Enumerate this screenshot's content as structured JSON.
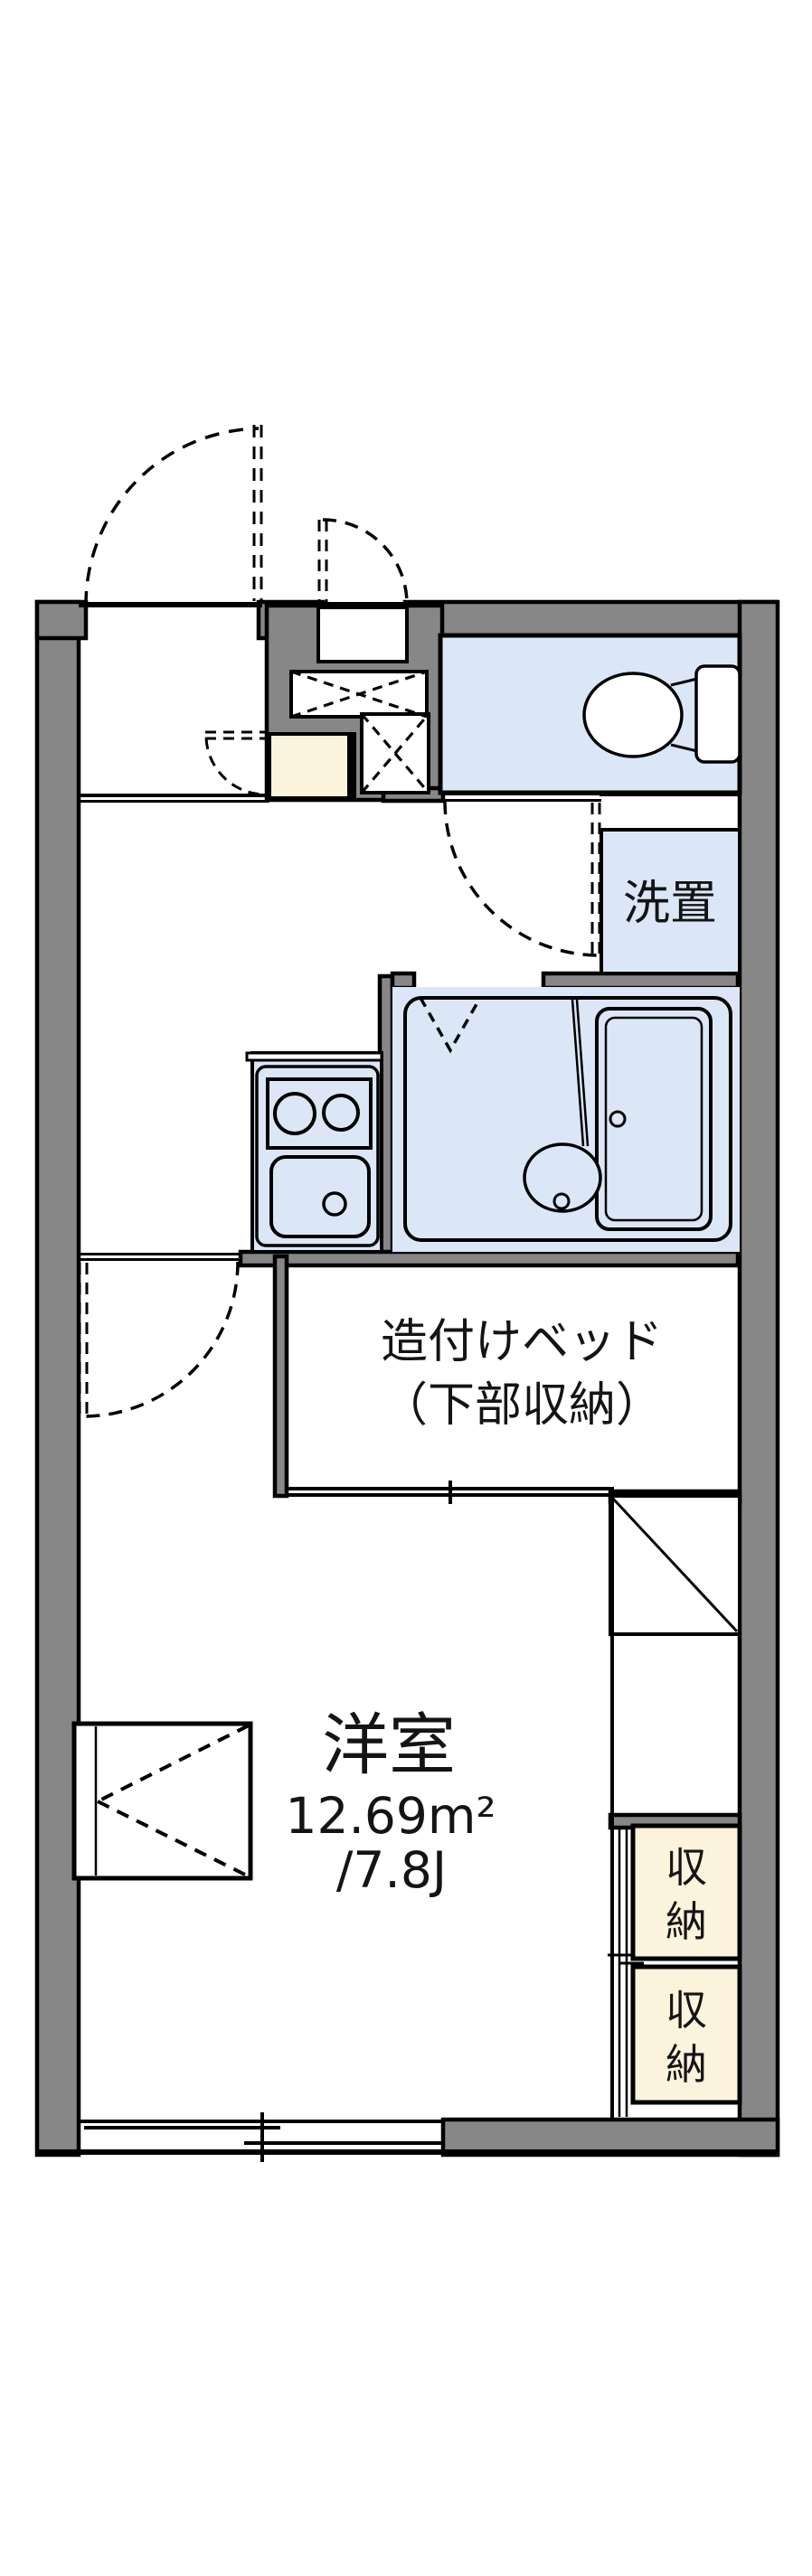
{
  "floorplan": {
    "labels": {
      "main_room_name": "洋室",
      "main_room_area_m2": "12.69m²",
      "main_room_area_tatami": "/7.8J",
      "built_in_bed_line1": "造付けベッド",
      "built_in_bed_line2": "（下部収納）",
      "laundry_space": "洗置",
      "storage_upper_char1": "収",
      "storage_upper_char2": "納",
      "storage_lower_char1": "収",
      "storage_lower_char2": "納"
    },
    "colors": {
      "wall": "#878787",
      "wet_area": "#dbe7f7",
      "storage": "#fcf3dc",
      "line": "#000000",
      "background": "#ffffff"
    }
  }
}
